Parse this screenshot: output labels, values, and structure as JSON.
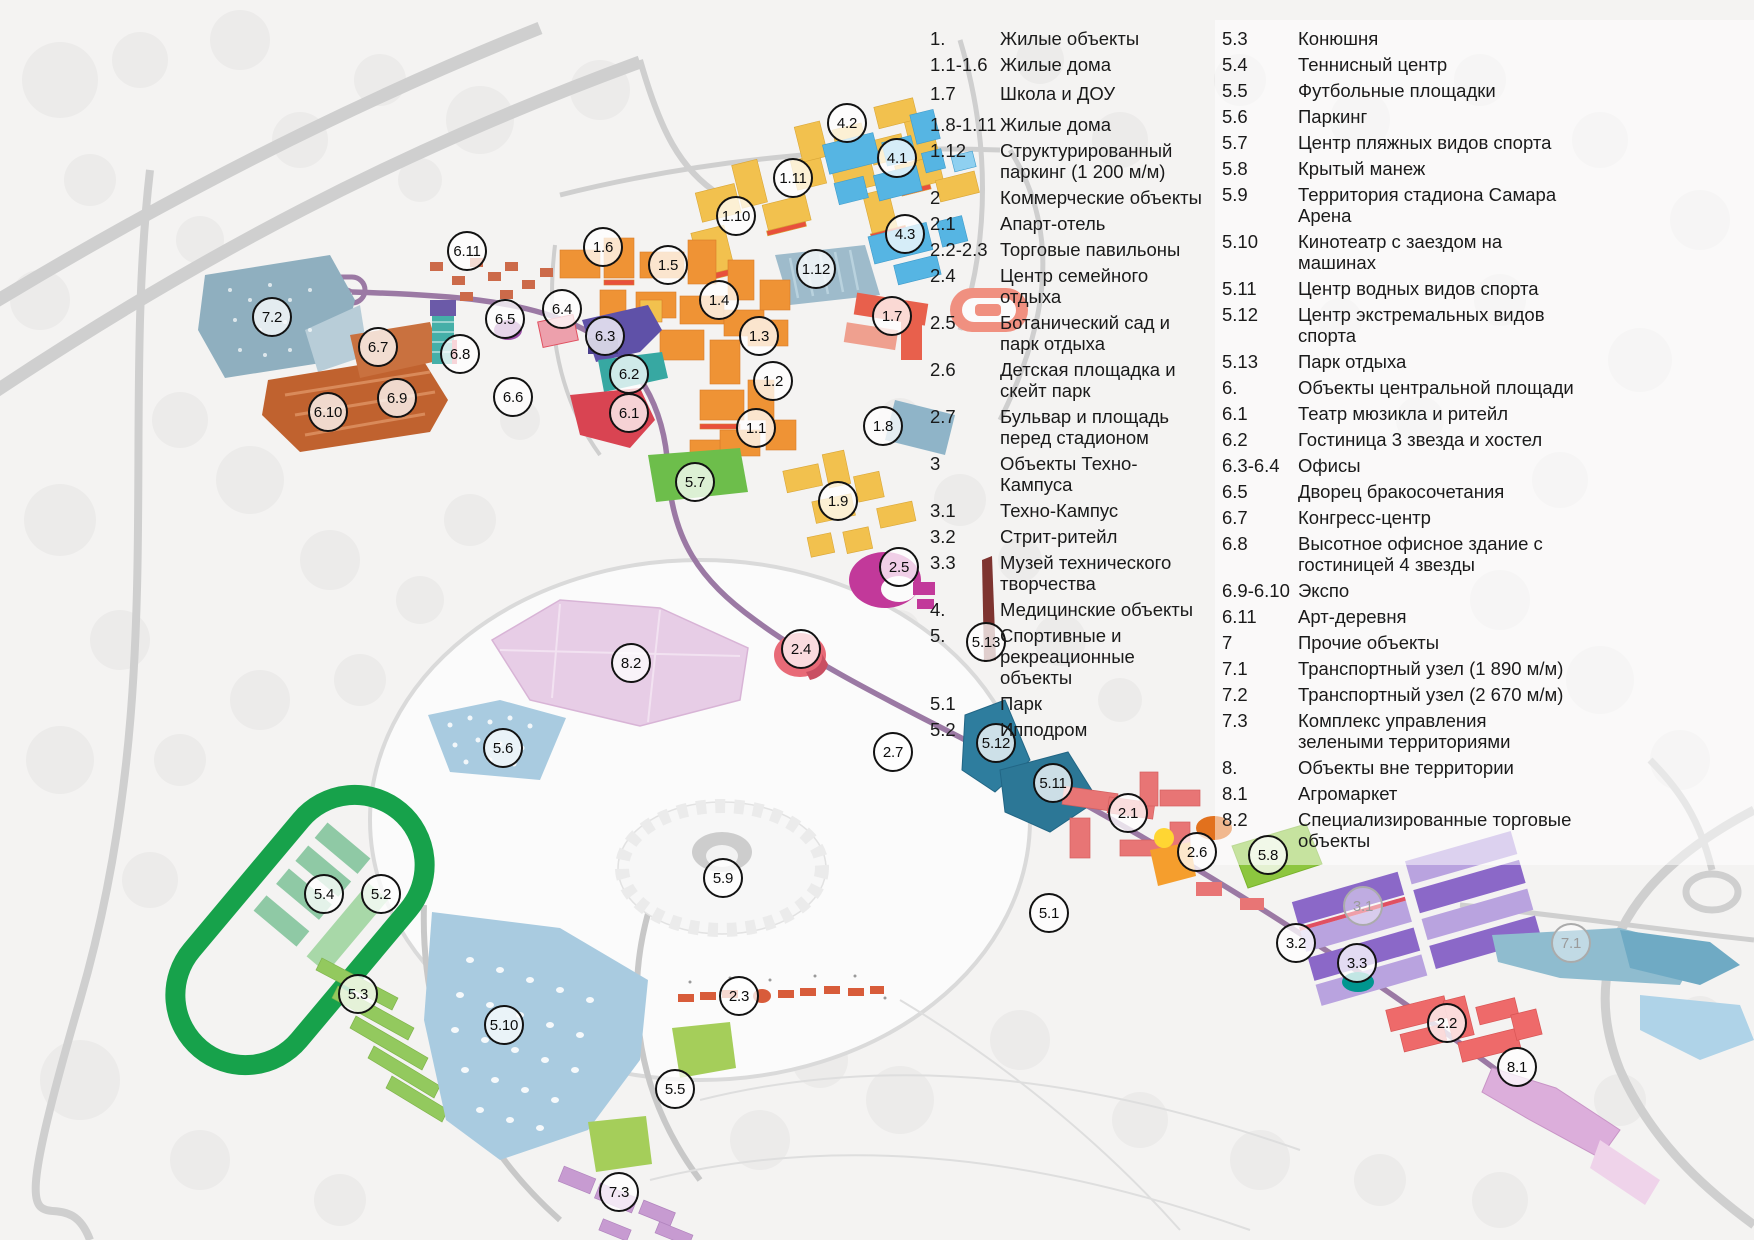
{
  "legend": {
    "columns": [
      {
        "rows": [
          {
            "num": "1.",
            "label": "Жилые объекты"
          },
          {
            "num": "1.1-1.6",
            "label": "Жилые дома"
          },
          {
            "num": "1.7",
            "label": "Школа и ДОУ"
          },
          {
            "num": "1.8-1.11",
            "label": "Жилые дома"
          },
          {
            "num": "1.12",
            "label": "Структурированный паркинг (1 200 м/м)"
          },
          {
            "num": "2",
            "label": "Коммерческие объекты"
          },
          {
            "num": "2.1",
            "label": "Апарт-отель"
          },
          {
            "num": "2.2-2.3",
            "label": "Торговые павильоны"
          },
          {
            "num": "2.4",
            "label": "Центр семейного отдыха"
          },
          {
            "num": "2.5",
            "label": "Ботанический сад и парк отдыха"
          },
          {
            "num": "2.6",
            "label": "Детская площадка и скейт парк"
          },
          {
            "num": "2.7",
            "label": "Бульвар и площадь перед стадионом"
          },
          {
            "num": "3",
            "label": "Объекты Техно-Кампуса"
          },
          {
            "num": "3.1",
            "label": "Техно-Кампус"
          },
          {
            "num": "3.2",
            "label": "Стрит-ритейл"
          },
          {
            "num": "3.3",
            "label": "Музей технического творчества"
          },
          {
            "num": "4.",
            "label": "Медицинские объекты"
          },
          {
            "num": "5.",
            "label": "Спортивные и рекреационные объекты"
          },
          {
            "num": "5.1",
            "label": "Парк"
          },
          {
            "num": "5.2",
            "label": "Ипподром"
          }
        ]
      },
      {
        "rows": [
          {
            "num": "5.3",
            "label": "Конюшня"
          },
          {
            "num": "5.4",
            "label": "Теннисный центр"
          },
          {
            "num": "5.5",
            "label": "Футбольные площадки"
          },
          {
            "num": "5.6",
            "label": "Паркинг"
          },
          {
            "num": "5.7",
            "label": "Центр пляжных видов спорта"
          },
          {
            "num": "5.8",
            "label": "Крытый манеж"
          },
          {
            "num": "5.9",
            "label": "Территория стадиона Самара Арена"
          },
          {
            "num": "5.10",
            "label": "Кинотеатр с заездом на машинах"
          },
          {
            "num": "5.11",
            "label": "Центр водных видов спорта"
          },
          {
            "num": "5.12",
            "label": "Центр экстремальных видов спорта"
          },
          {
            "num": "5.13",
            "label": "Парк отдыха"
          },
          {
            "num": "6.",
            "label": "Объекты центральной площади"
          },
          {
            "num": "6.1",
            "label": "Театр мюзикла и ритейл"
          },
          {
            "num": "6.2",
            "label": "Гостиница 3 звезда и хостел"
          },
          {
            "num": "6.3-6.4",
            "label": "Офисы"
          },
          {
            "num": "6.5",
            "label": "Дворец бракосочетания"
          },
          {
            "num": "6.7",
            "label": "Конгресс-центр"
          },
          {
            "num": "6.8",
            "label": "Высотное офисное здание с гостиницей 4 звезды"
          },
          {
            "num": "6.9-6.10",
            "label": "Экспо"
          },
          {
            "num": "6.11",
            "label": "Арт-деревня"
          },
          {
            "num": "7",
            "label": "Прочие объекты"
          },
          {
            "num": "7.1",
            "label": "Транспортный узел (1 890 м/м)"
          },
          {
            "num": "7.2",
            "label": "Транспортный узел (2 670 м/м)"
          },
          {
            "num": "7.3",
            "label": "Комплекс управления зелеными территориями"
          },
          {
            "num": "8.",
            "label": "Объекты вне территории"
          },
          {
            "num": "8.1",
            "label": "Агромаркет"
          },
          {
            "num": "8.2",
            "label": "Специализированные торговые объекты"
          }
        ]
      }
    ]
  },
  "markers": [
    {
      "label": "4.2",
      "x": 847,
      "y": 123
    },
    {
      "label": "4.1",
      "x": 897,
      "y": 158
    },
    {
      "label": "1.11",
      "x": 793,
      "y": 178
    },
    {
      "label": "1.10",
      "x": 736,
      "y": 216
    },
    {
      "label": "4.3",
      "x": 905,
      "y": 234
    },
    {
      "label": "1.6",
      "x": 603,
      "y": 247
    },
    {
      "label": "6.11",
      "x": 467,
      "y": 251
    },
    {
      "label": "1.5",
      "x": 668,
      "y": 265
    },
    {
      "label": "1.12",
      "x": 816,
      "y": 269
    },
    {
      "label": "1.4",
      "x": 719,
      "y": 300
    },
    {
      "label": "6.4",
      "x": 562,
      "y": 309
    },
    {
      "label": "7.2",
      "x": 272,
      "y": 317
    },
    {
      "label": "6.5",
      "x": 505,
      "y": 319
    },
    {
      "label": "1.7",
      "x": 892,
      "y": 316
    },
    {
      "label": "6.3",
      "x": 605,
      "y": 336
    },
    {
      "label": "1.3",
      "x": 759,
      "y": 336
    },
    {
      "label": "6.7",
      "x": 378,
      "y": 347
    },
    {
      "label": "6.8",
      "x": 460,
      "y": 354
    },
    {
      "label": "6.2",
      "x": 629,
      "y": 374
    },
    {
      "label": "1.2",
      "x": 773,
      "y": 381
    },
    {
      "label": "6.9",
      "x": 397,
      "y": 398
    },
    {
      "label": "6.6",
      "x": 513,
      "y": 397
    },
    {
      "label": "6.10",
      "x": 328,
      "y": 412
    },
    {
      "label": "6.1",
      "x": 629,
      "y": 413
    },
    {
      "label": "1.1",
      "x": 756,
      "y": 428
    },
    {
      "label": "1.8",
      "x": 883,
      "y": 426
    },
    {
      "label": "5.7",
      "x": 695,
      "y": 482
    },
    {
      "label": "1.9",
      "x": 838,
      "y": 501
    },
    {
      "label": "2.5",
      "x": 899,
      "y": 567
    },
    {
      "label": "5.13",
      "x": 986,
      "y": 642
    },
    {
      "label": "2.4",
      "x": 801,
      "y": 649
    },
    {
      "label": "8.2",
      "x": 631,
      "y": 663
    },
    {
      "label": "5.6",
      "x": 503,
      "y": 748
    },
    {
      "label": "5.12",
      "x": 996,
      "y": 743
    },
    {
      "label": "2.7",
      "x": 893,
      "y": 752
    },
    {
      "label": "5.11",
      "x": 1053,
      "y": 783
    },
    {
      "label": "2.1",
      "x": 1128,
      "y": 813
    },
    {
      "label": "2.6",
      "x": 1197,
      "y": 852
    },
    {
      "label": "5.8",
      "x": 1268,
      "y": 855
    },
    {
      "label": "5.9",
      "x": 723,
      "y": 878
    },
    {
      "label": "5.4",
      "x": 324,
      "y": 894
    },
    {
      "label": "5.2",
      "x": 381,
      "y": 894
    },
    {
      "label": "3.1",
      "x": 1363,
      "y": 906,
      "muted": true
    },
    {
      "label": "5.1",
      "x": 1049,
      "y": 913
    },
    {
      "label": "3.2",
      "x": 1296,
      "y": 943
    },
    {
      "label": "7.1",
      "x": 1571,
      "y": 943,
      "muted": true
    },
    {
      "label": "3.3",
      "x": 1357,
      "y": 963
    },
    {
      "label": "5.3",
      "x": 358,
      "y": 994
    },
    {
      "label": "2.3",
      "x": 739,
      "y": 996
    },
    {
      "label": "2.2",
      "x": 1447,
      "y": 1023
    },
    {
      "label": "5.10",
      "x": 504,
      "y": 1025
    },
    {
      "label": "8.1",
      "x": 1517,
      "y": 1067
    },
    {
      "label": "5.5",
      "x": 675,
      "y": 1089
    },
    {
      "label": "7.3",
      "x": 619,
      "y": 1192
    }
  ],
  "palette": {
    "legend_text": "#1a1a1a",
    "marker_border": "#121212",
    "marker_muted": "#ababab",
    "residential_yellow": "#F2C14E",
    "residential_orange": "#EF9335",
    "medical_blue": "#56B5E3",
    "parking_steel": "#9EBBCB",
    "school_red": "#E8604C",
    "office_purple": "#5F51A8",
    "hotel_teal": "#37A8A2",
    "theater_red": "#D94452",
    "wedding_magenta": "#9C4FA8",
    "congress_brown": "#C9713F",
    "expo_terracotta": "#C0622F",
    "beach_green": "#6DBE4B",
    "botanic_magenta": "#C2399A",
    "family_rose": "#E86A77",
    "trade_pink": "#E7CDE6",
    "parking_lightblue": "#A9CBE0",
    "extreme_teal": "#2E7D9E",
    "apart_coral": "#E87575",
    "manege_lime": "#8DC63F",
    "campus_purple": "#8B68C8",
    "campus_light": "#B9A3DF",
    "museum_teal": "#00968F",
    "agro_lilac": "#DCAEDB",
    "hippodrome_green": "#17A24B",
    "stables_green": "#93C95E",
    "fields_green": "#A5CE5A",
    "greencomplex_orchid": "#C79BD1",
    "pavilion_red": "#D85C3A",
    "road_gray": "#CFCFCF",
    "boulevard_purple": "#9B79A4",
    "water_blue": "#8FBCCF"
  }
}
